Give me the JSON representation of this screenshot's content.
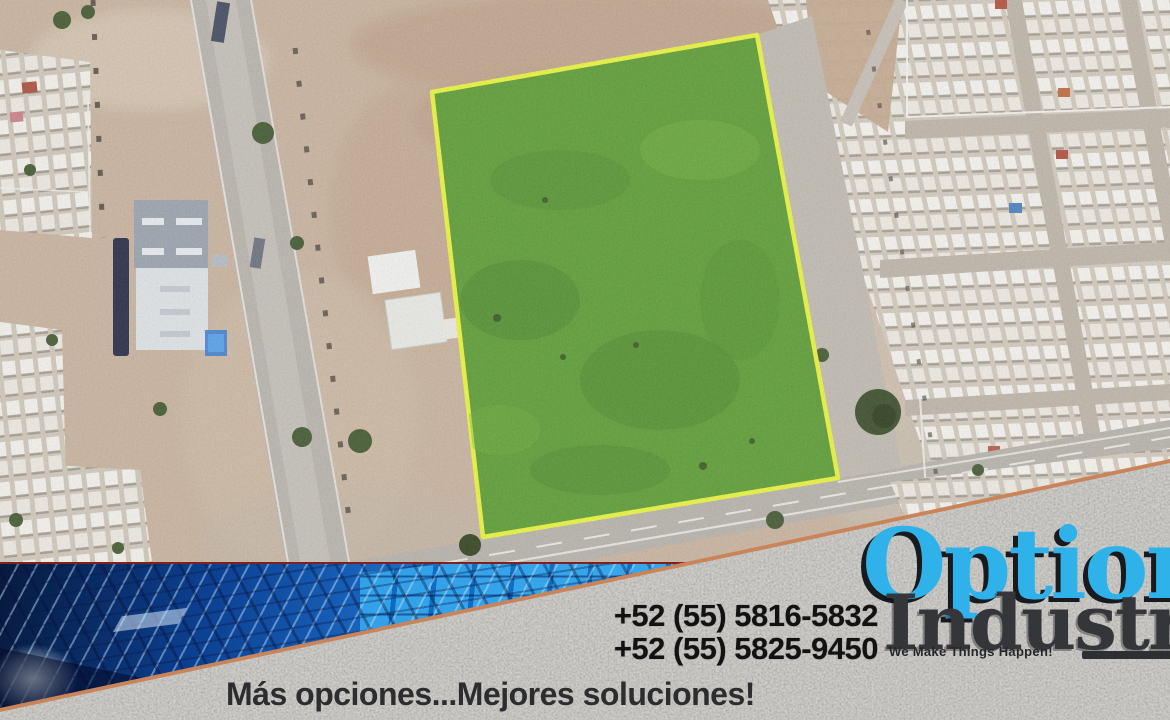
{
  "contact": {
    "phone_line_1": "+52 (55) 5816-5832",
    "phone_line_2": "+52 (55) 5825-9450"
  },
  "brand": {
    "word_top": "Options",
    "word_bottom": "Industry",
    "tagline": "We Make Things Happen!",
    "accent_color": "#2fb2e9",
    "dark_color": "#35363a"
  },
  "slogan": "Más opciones...Mejores soluciones!",
  "listing_map": {
    "plot_fill_color": "#5c9c33",
    "plot_outline_color": "#e9f43c",
    "granite_band_color": "#cbc8c2",
    "granite_edge_color": "#c98459"
  }
}
